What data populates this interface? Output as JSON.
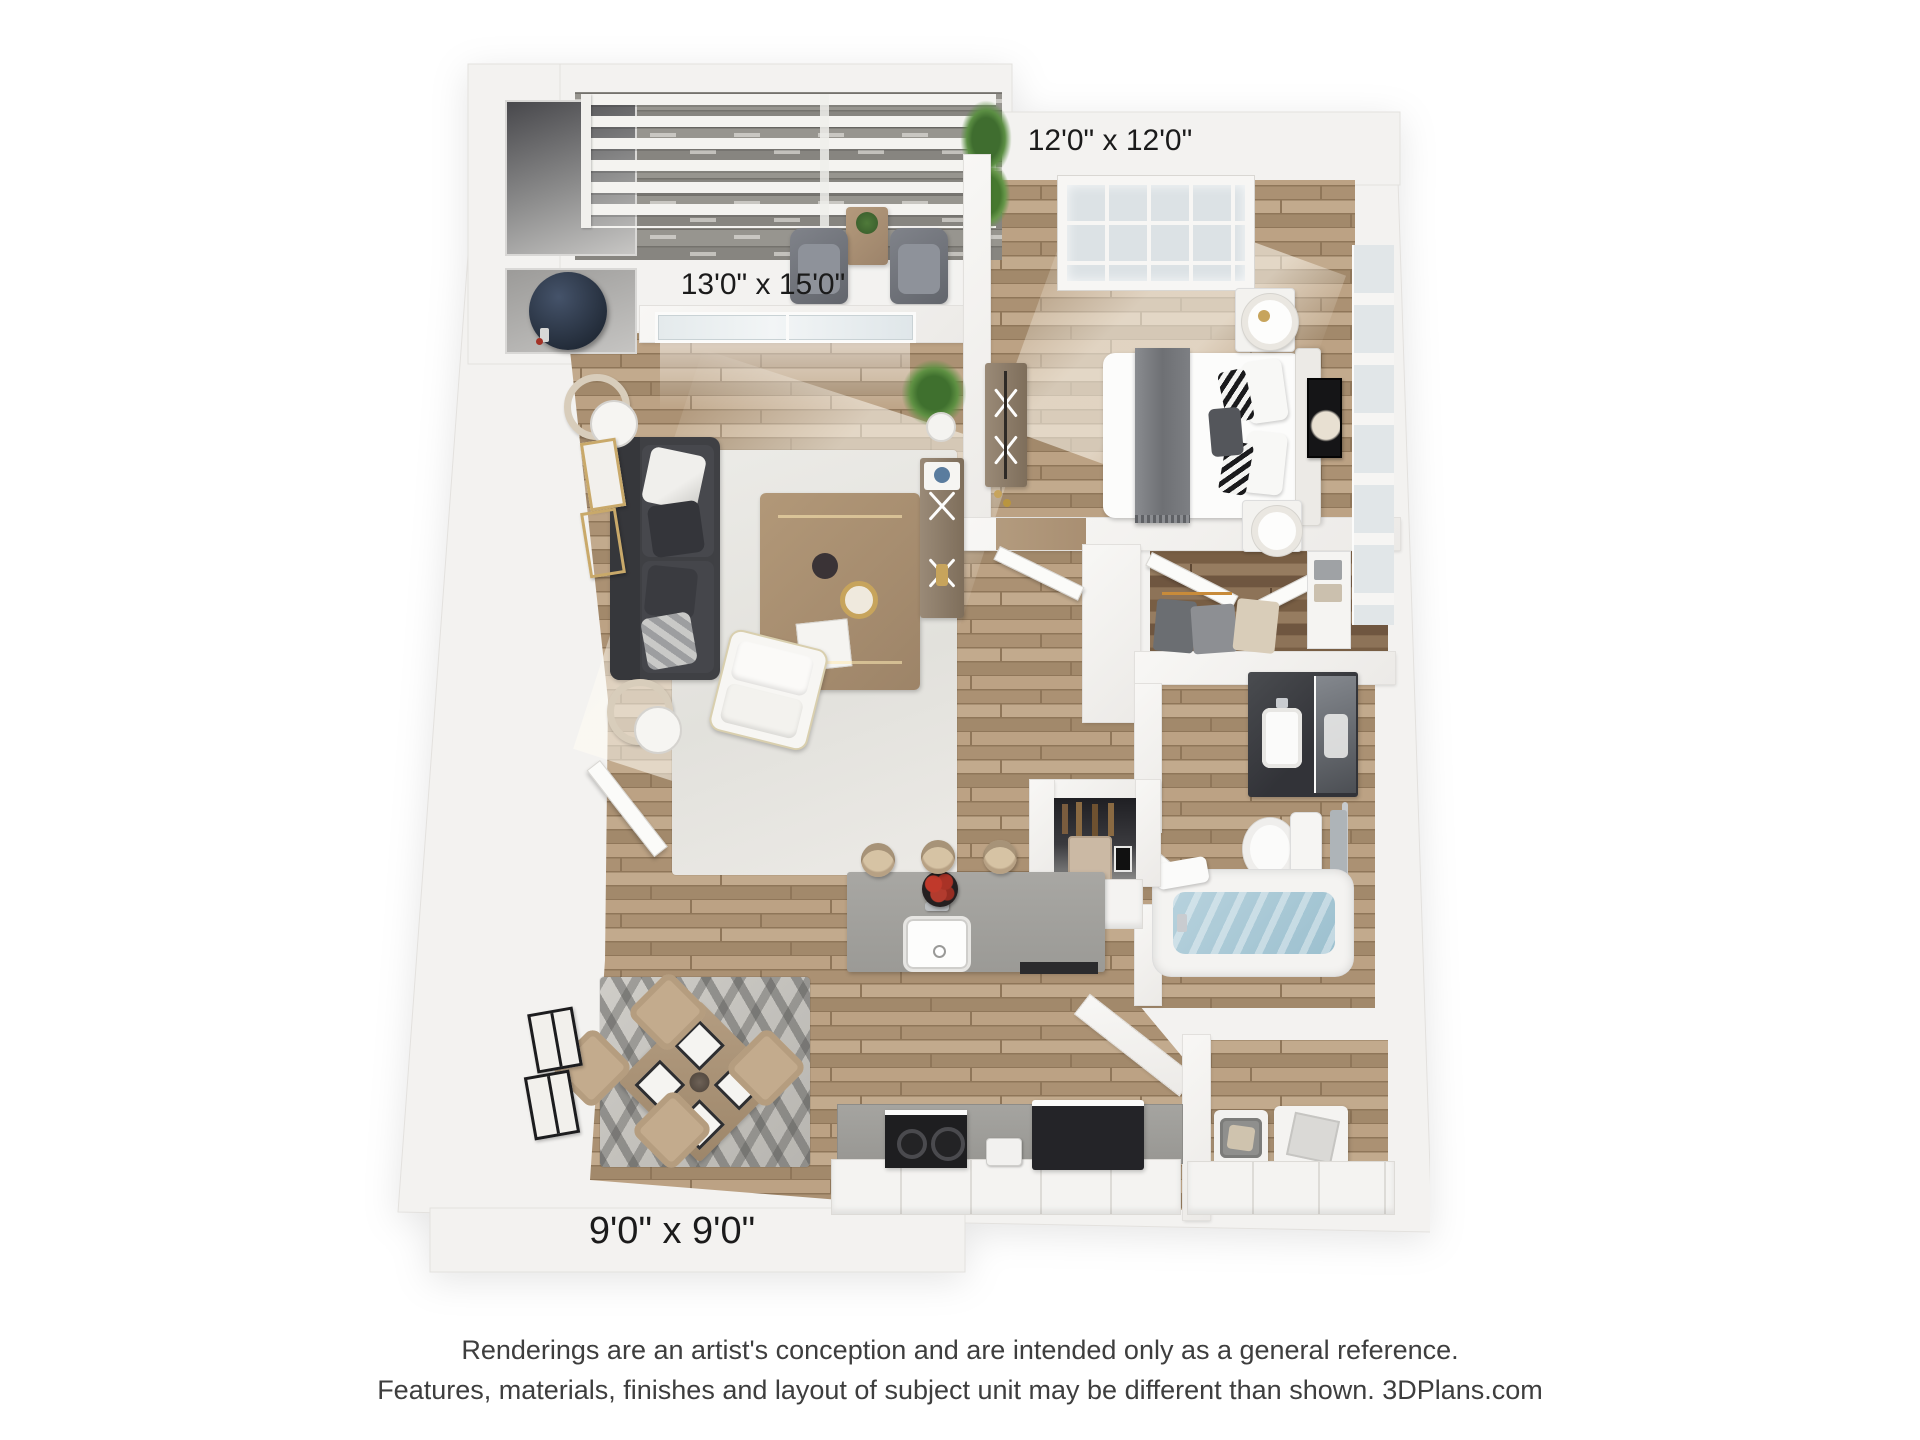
{
  "floor_plan": {
    "labels": {
      "bedroom_dims": "12'0\" x 12'0\"",
      "patio_dims": "13'0\" x 15'0\"",
      "dining_dims": "9'0\" x 9'0\""
    },
    "disclaimer": {
      "line1": "Renderings are an artist's conception and are intended only as a general reference.",
      "line2": "Features, materials, finishes and layout of subject unit may be different than shown. 3DPlans.com"
    },
    "palette": {
      "wall_white": "#f3f2f0",
      "wood_floor": "#b39b7e",
      "dark_wood": "#8c7257",
      "patio_deck": "#908e89",
      "sofa_charcoal": "#3f4044",
      "island_gray": "#a2a19d",
      "tub_water": "#a9c9d6",
      "fruit_red": "#b03040",
      "water_heater_navy": "#2e3a4a"
    }
  }
}
